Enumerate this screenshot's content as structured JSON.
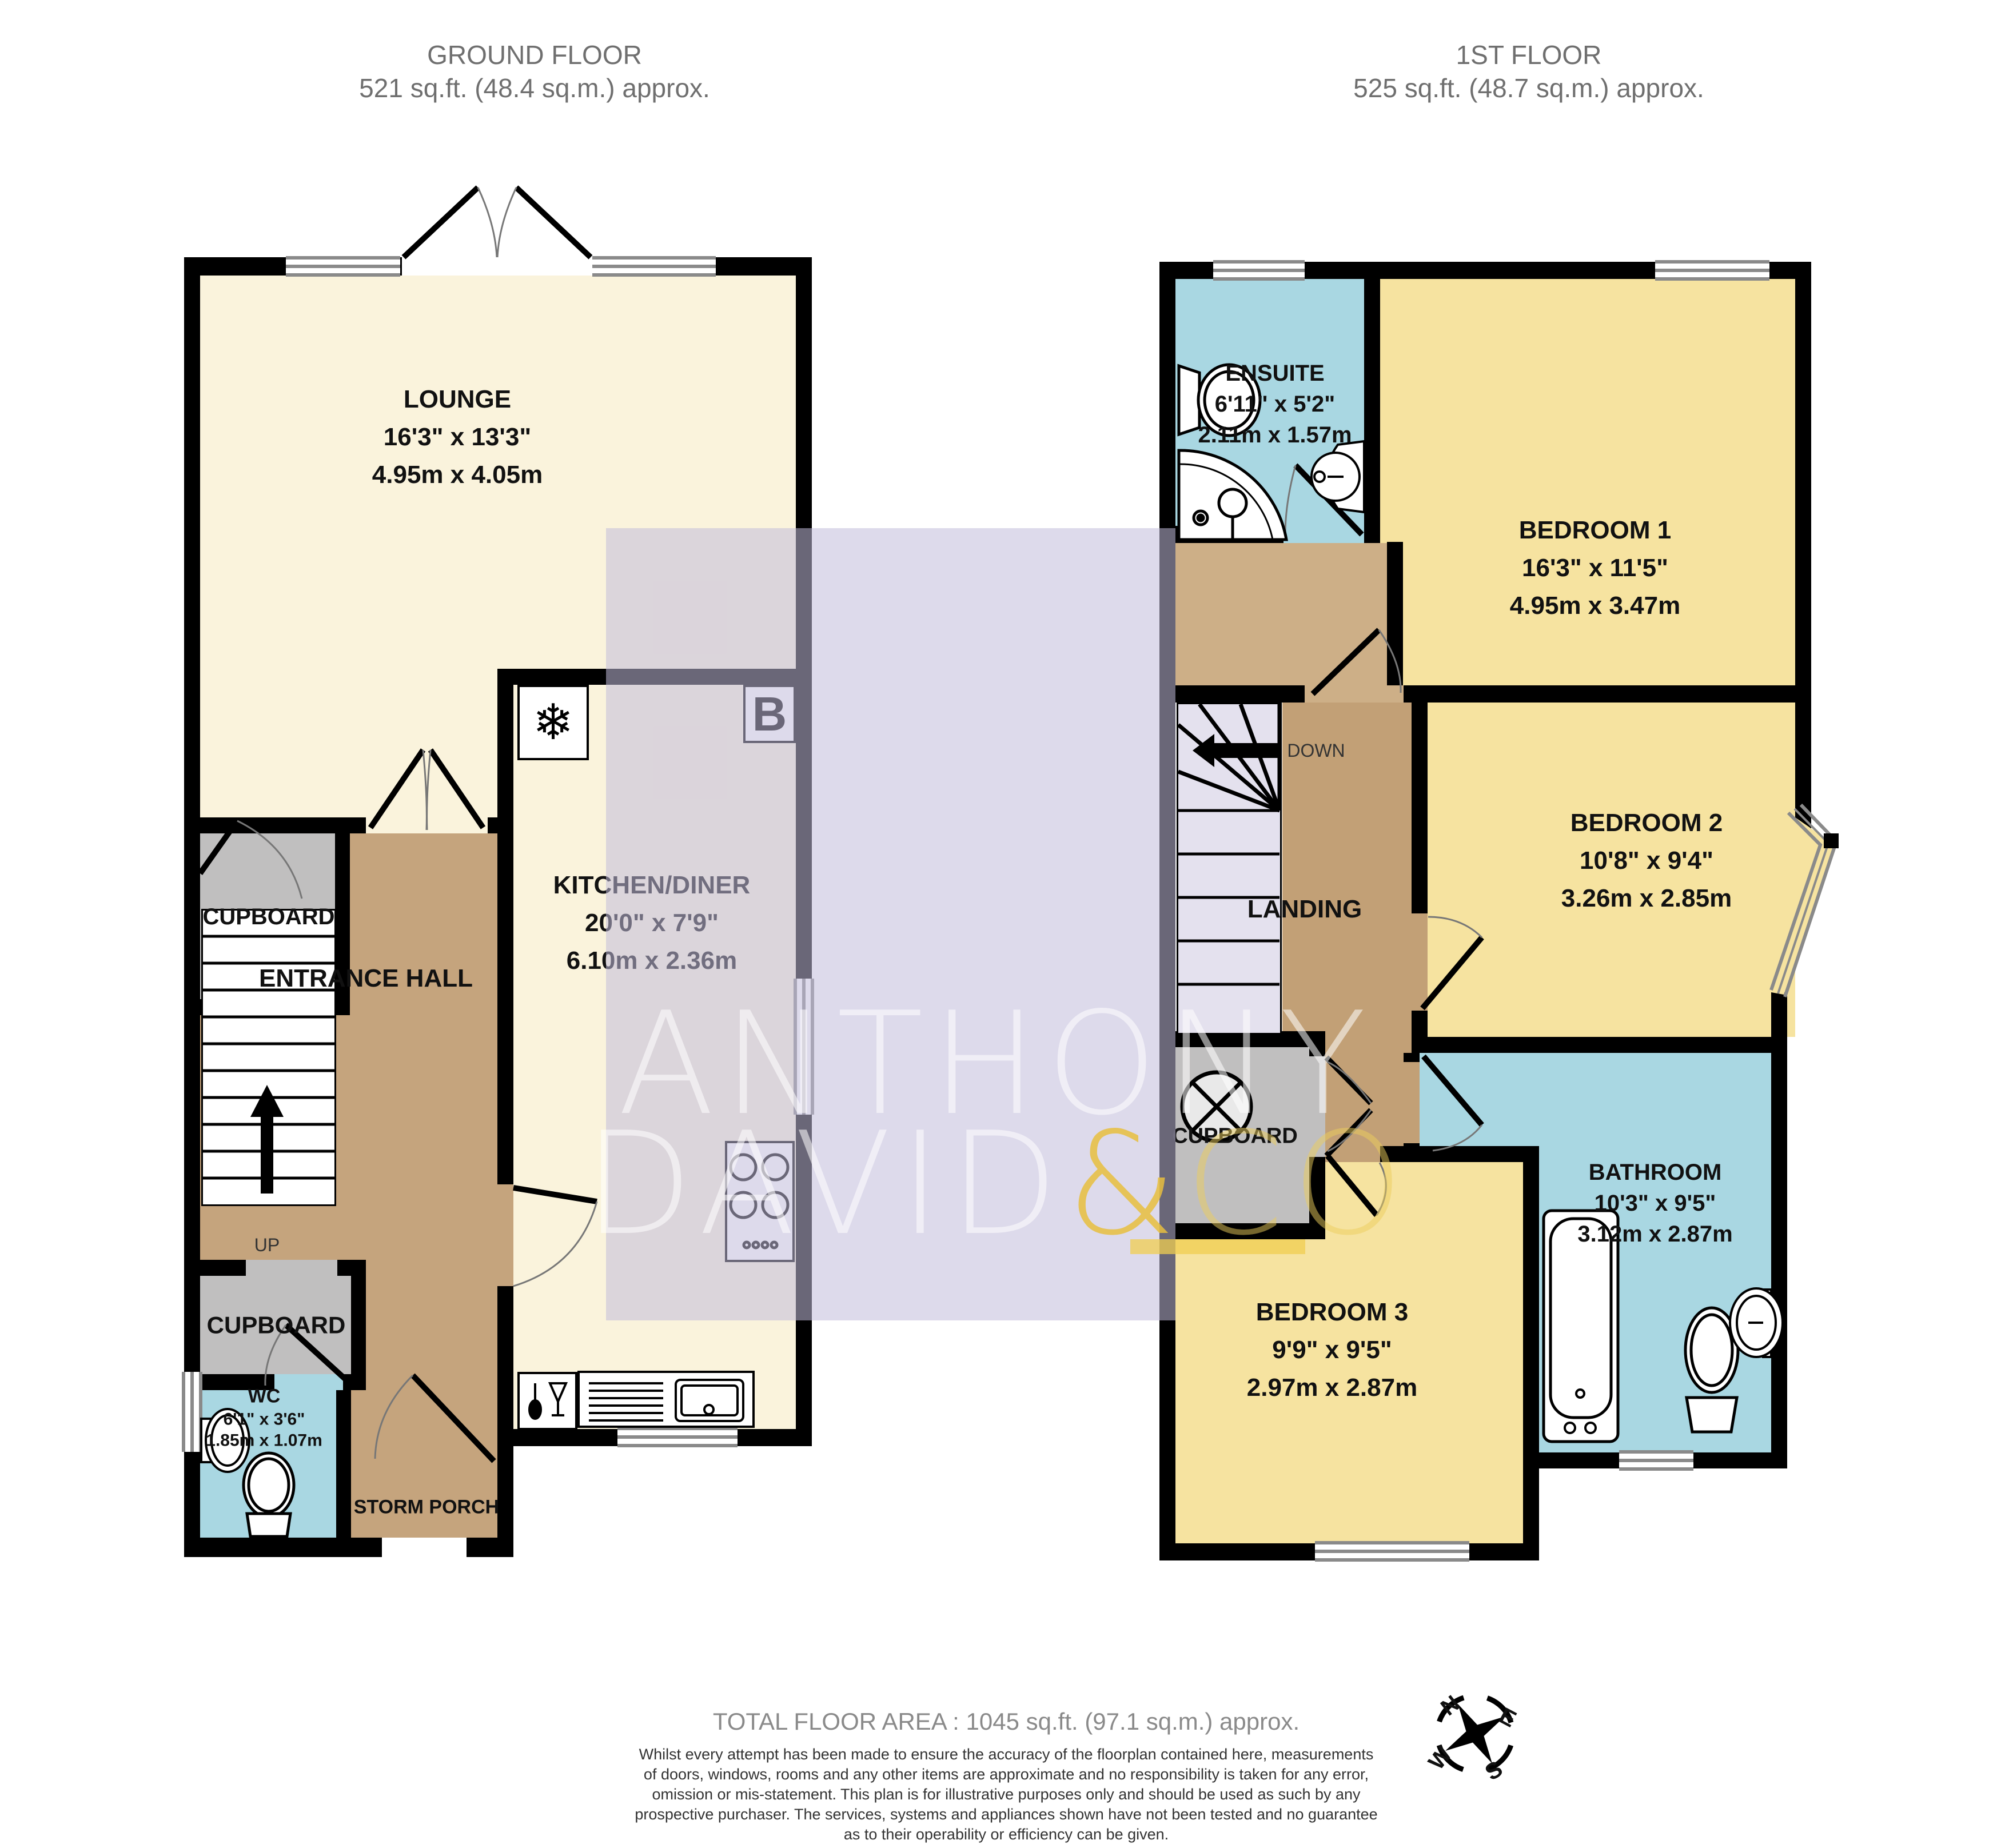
{
  "header": {
    "ground": {
      "title": "GROUND FLOOR",
      "area": "521 sq.ft. (48.4 sq.m.) approx."
    },
    "first": {
      "title": "1ST FLOOR",
      "area": "525 sq.ft. (48.7 sq.m.) approx."
    }
  },
  "ground_floor": {
    "lounge": {
      "name": "LOUNGE",
      "dims_ft": "16'3\" x 13'3\"",
      "dims_m": "4.95m x 4.05m"
    },
    "kitchen": {
      "name": "KITCHEN/DINER",
      "dims_ft": "20'0\" x 7'9\"",
      "dims_m": "6.10m x 2.36m"
    },
    "hall": {
      "name": "ENTRANCE HALL"
    },
    "cupboard_upper": {
      "name": "CUPBOARD"
    },
    "cupboard_lower": {
      "name": "CUPBOARD"
    },
    "wc": {
      "name": "WC",
      "dims_ft": "6'1\" x 3'6\"",
      "dims_m": "1.85m x 1.07m"
    },
    "porch": {
      "name": "STORM PORCH"
    },
    "stairs": {
      "label": "UP"
    },
    "boiler": {
      "label": "B"
    },
    "freezer_icon": "❄"
  },
  "first_floor": {
    "ensuite": {
      "name": "ENSUITE",
      "dims_ft": "6'11\" x 5'2\"",
      "dims_m": "2.11m x 1.57m"
    },
    "bedroom1": {
      "name": "BEDROOM 1",
      "dims_ft": "16'3\" x 11'5\"",
      "dims_m": "4.95m x 3.47m"
    },
    "bedroom2": {
      "name": "BEDROOM 2",
      "dims_ft": "10'8\" x 9'4\"",
      "dims_m": "3.26m x 2.85m"
    },
    "bedroom3": {
      "name": "BEDROOM 3",
      "dims_ft": "9'9\" x 9'5\"",
      "dims_m": "2.97m x 2.87m"
    },
    "bathroom": {
      "name": "BATHROOM",
      "dims_ft": "10'3\" x 9'5\"",
      "dims_m": "3.12m x 2.87m"
    },
    "landing": {
      "name": "LANDING"
    },
    "cupboard": {
      "name": "CUPBOARD"
    },
    "stairs": {
      "label": "DOWN"
    }
  },
  "watermark": {
    "line1": "ANTHONY",
    "line2": "DAVID",
    "amp": "&",
    "co": "CO"
  },
  "compass": {
    "n": "N",
    "e": "E",
    "s": "S",
    "w": "W"
  },
  "footer": {
    "total": "TOTAL FLOOR AREA : 1045 sq.ft. (97.1 sq.m.) approx.",
    "disclaimer": [
      "Whilst every attempt has been made to ensure the accuracy of the floorplan contained here, measurements",
      "of doors, windows, rooms and any other items are approximate and no responsibility is taken for any error,",
      "omission or mis-statement. This plan is for illustrative purposes only and should be used as such by any",
      "prospective purchaser. The services, systems and appliances shown have not been tested and no guarantee",
      "as to their operability or efficiency can be given."
    ],
    "credit": "Made with Metropix ©2025"
  },
  "palette": {
    "wall": "#000000",
    "cream": "#FAF3DC",
    "yellow": "#F6E3A0",
    "blue": "#A9D7E2",
    "brown": "#C5A47D",
    "tan": "#CDAF87",
    "gray_cupboard": "#C0BFBF",
    "stairs_lavender": "#E4E1EE",
    "watermark": "#C1BBDB",
    "gold": "#E7BE3E",
    "text_gray": "#6F6F6F"
  }
}
